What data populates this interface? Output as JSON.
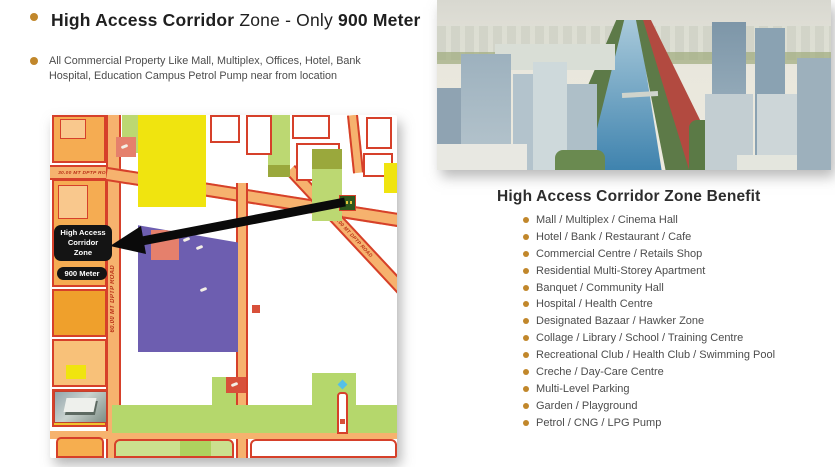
{
  "intro": {
    "heading": {
      "bold_lead": "High Access Corridor",
      "regular_mid": " Zone - Only ",
      "bold_tail": "900 Meter"
    },
    "subtext": "All Commercial Property Like Mall, Multiplex, Offices, Hotel, Bank Hospital, Education Campus Petrol Pump near from location"
  },
  "map": {
    "zone_label_line1": "High Access",
    "zone_label_line2": "Corridor",
    "zone_label_line3": "Zone",
    "distance_label": "900  Meter",
    "roads": {
      "top_road": "30.00 MT DPTP ROAD",
      "vertical_road": "60.00 MT DPTP ROAD",
      "diagonal_road": "30.00 MT DPTP ROAD"
    }
  },
  "benefits": {
    "title": "High Access Corridor Zone Benefit",
    "items": [
      "Mall / Multiplex / Cinema Hall",
      "Hotel / Bank / Restaurant / Cafe",
      "Commercial Centre / Retails Shop",
      "Residential Multi-Storey Apartment",
      "Banquet / Community Hall",
      "Hospital / Health Centre",
      "Designated Bazaar / Hawker Zone",
      "Collage / Library / School / Training Centre",
      "Recreational Club / Health Club / Swimming Pool",
      "Creche / Day-Care Centre",
      "Multi-Level Parking",
      "Garden / Playground",
      "Petrol / CNG / LPG Pump"
    ]
  },
  "colors": {
    "bullet_gold": "#c1872b",
    "road_fill": "#f6b26e",
    "road_border": "#d6402a",
    "block_orange": "#f5ac52",
    "block_yellow": "#f0e40f",
    "block_purple": "#6d5eb0",
    "block_lime": "#bcd872",
    "block_salmon": "#e5806c",
    "marker_green": "#2f571d",
    "canal_blue": "#4a8cb8"
  }
}
